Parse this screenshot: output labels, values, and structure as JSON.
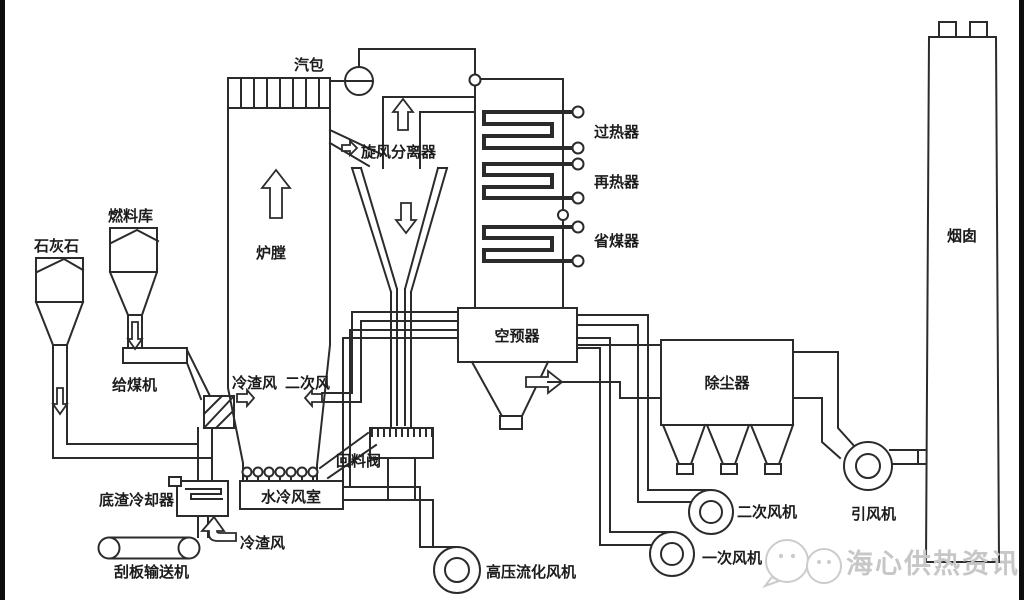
{
  "colors": {
    "line": "#2b2b2b",
    "background": "#ffffff",
    "watermark": "#c7c7c7",
    "edge_bar": "#0d0d0d"
  },
  "labels": {
    "steam_drum": "汽包",
    "cyclone_separator": "旋风分离器",
    "furnace": "炉膛",
    "superheater": "过热器",
    "reheater": "再热器",
    "economizer": "省煤器",
    "air_preheater": "空预器",
    "dust_collector": "除尘器",
    "chimney": "烟囱",
    "limestone": "石灰石",
    "fuel_bunker": "燃料库",
    "coal_feeder": "给煤机",
    "cold_slag_air_upper": "冷渣风",
    "secondary_air": "二次风",
    "return_valve": "回料阀",
    "water_cooled_chamber": "水冷风室",
    "bottom_slag_cooler": "底渣冷却器",
    "cold_slag_air_lower": "冷渣风",
    "scraper_conveyor": "刮板输送机",
    "hp_fluidizing_fan": "高压流化风机",
    "primary_air_fan": "一次风机",
    "secondary_air_fan": "二次风机",
    "induced_draft_fan": "引风机",
    "watermark_text": "海心供热资讯"
  }
}
